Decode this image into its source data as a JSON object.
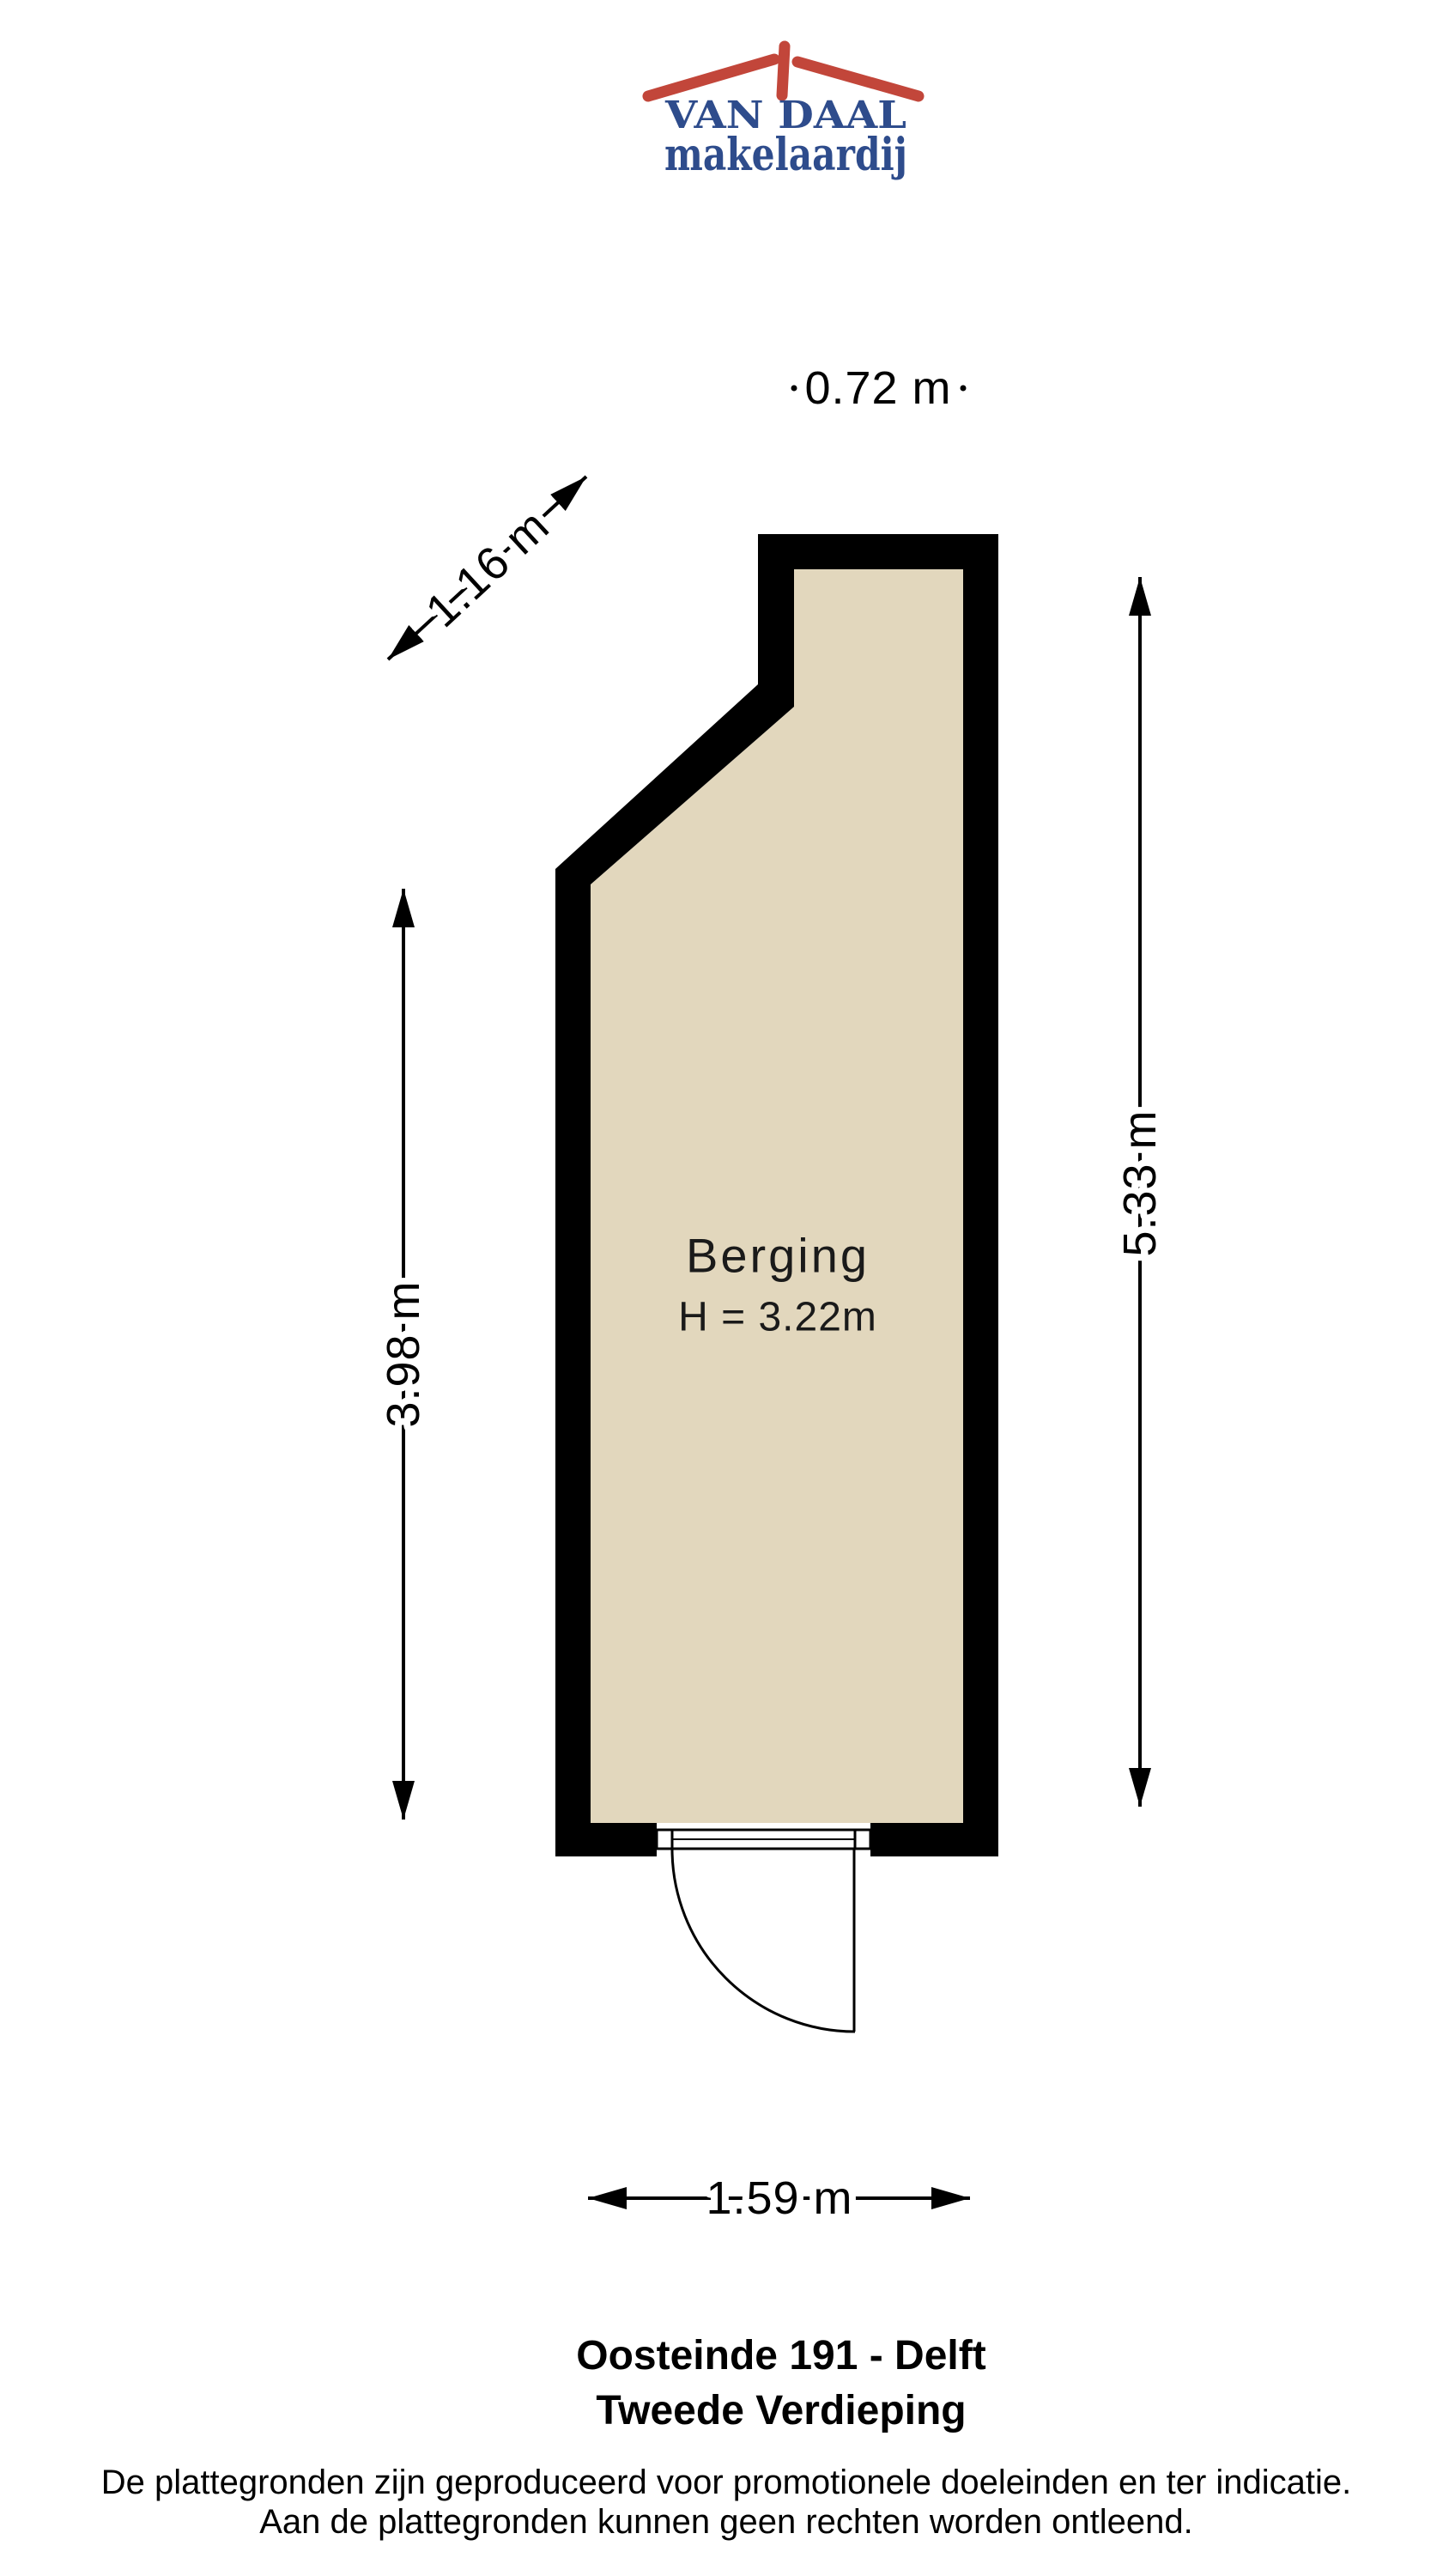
{
  "logo": {
    "name": "VAN DAAL",
    "tagline": "makelaardij",
    "colors": {
      "roof_red": "#c2463a",
      "navy": "#2e4c8c"
    }
  },
  "floorplan": {
    "room": {
      "label": "Berging",
      "height_label": "H = 3.22m"
    },
    "floor_color": "#e2d7bd",
    "wall_color": "#000000",
    "dimensions": {
      "top": "0.72 m",
      "diagonal": "1.16 m",
      "left": "3.98 m",
      "right": "5.33 m",
      "bottom": "1.59 m"
    }
  },
  "footer": {
    "title_line1": "Oosteinde 191 - Delft",
    "title_line2": "Tweede Verdieping",
    "disclaimer_line1": "De plattegronden zijn geproduceerd voor promotionele doeleinden en ter indicatie.",
    "disclaimer_line2": "Aan de plattegronden kunnen geen rechten worden ontleend."
  }
}
